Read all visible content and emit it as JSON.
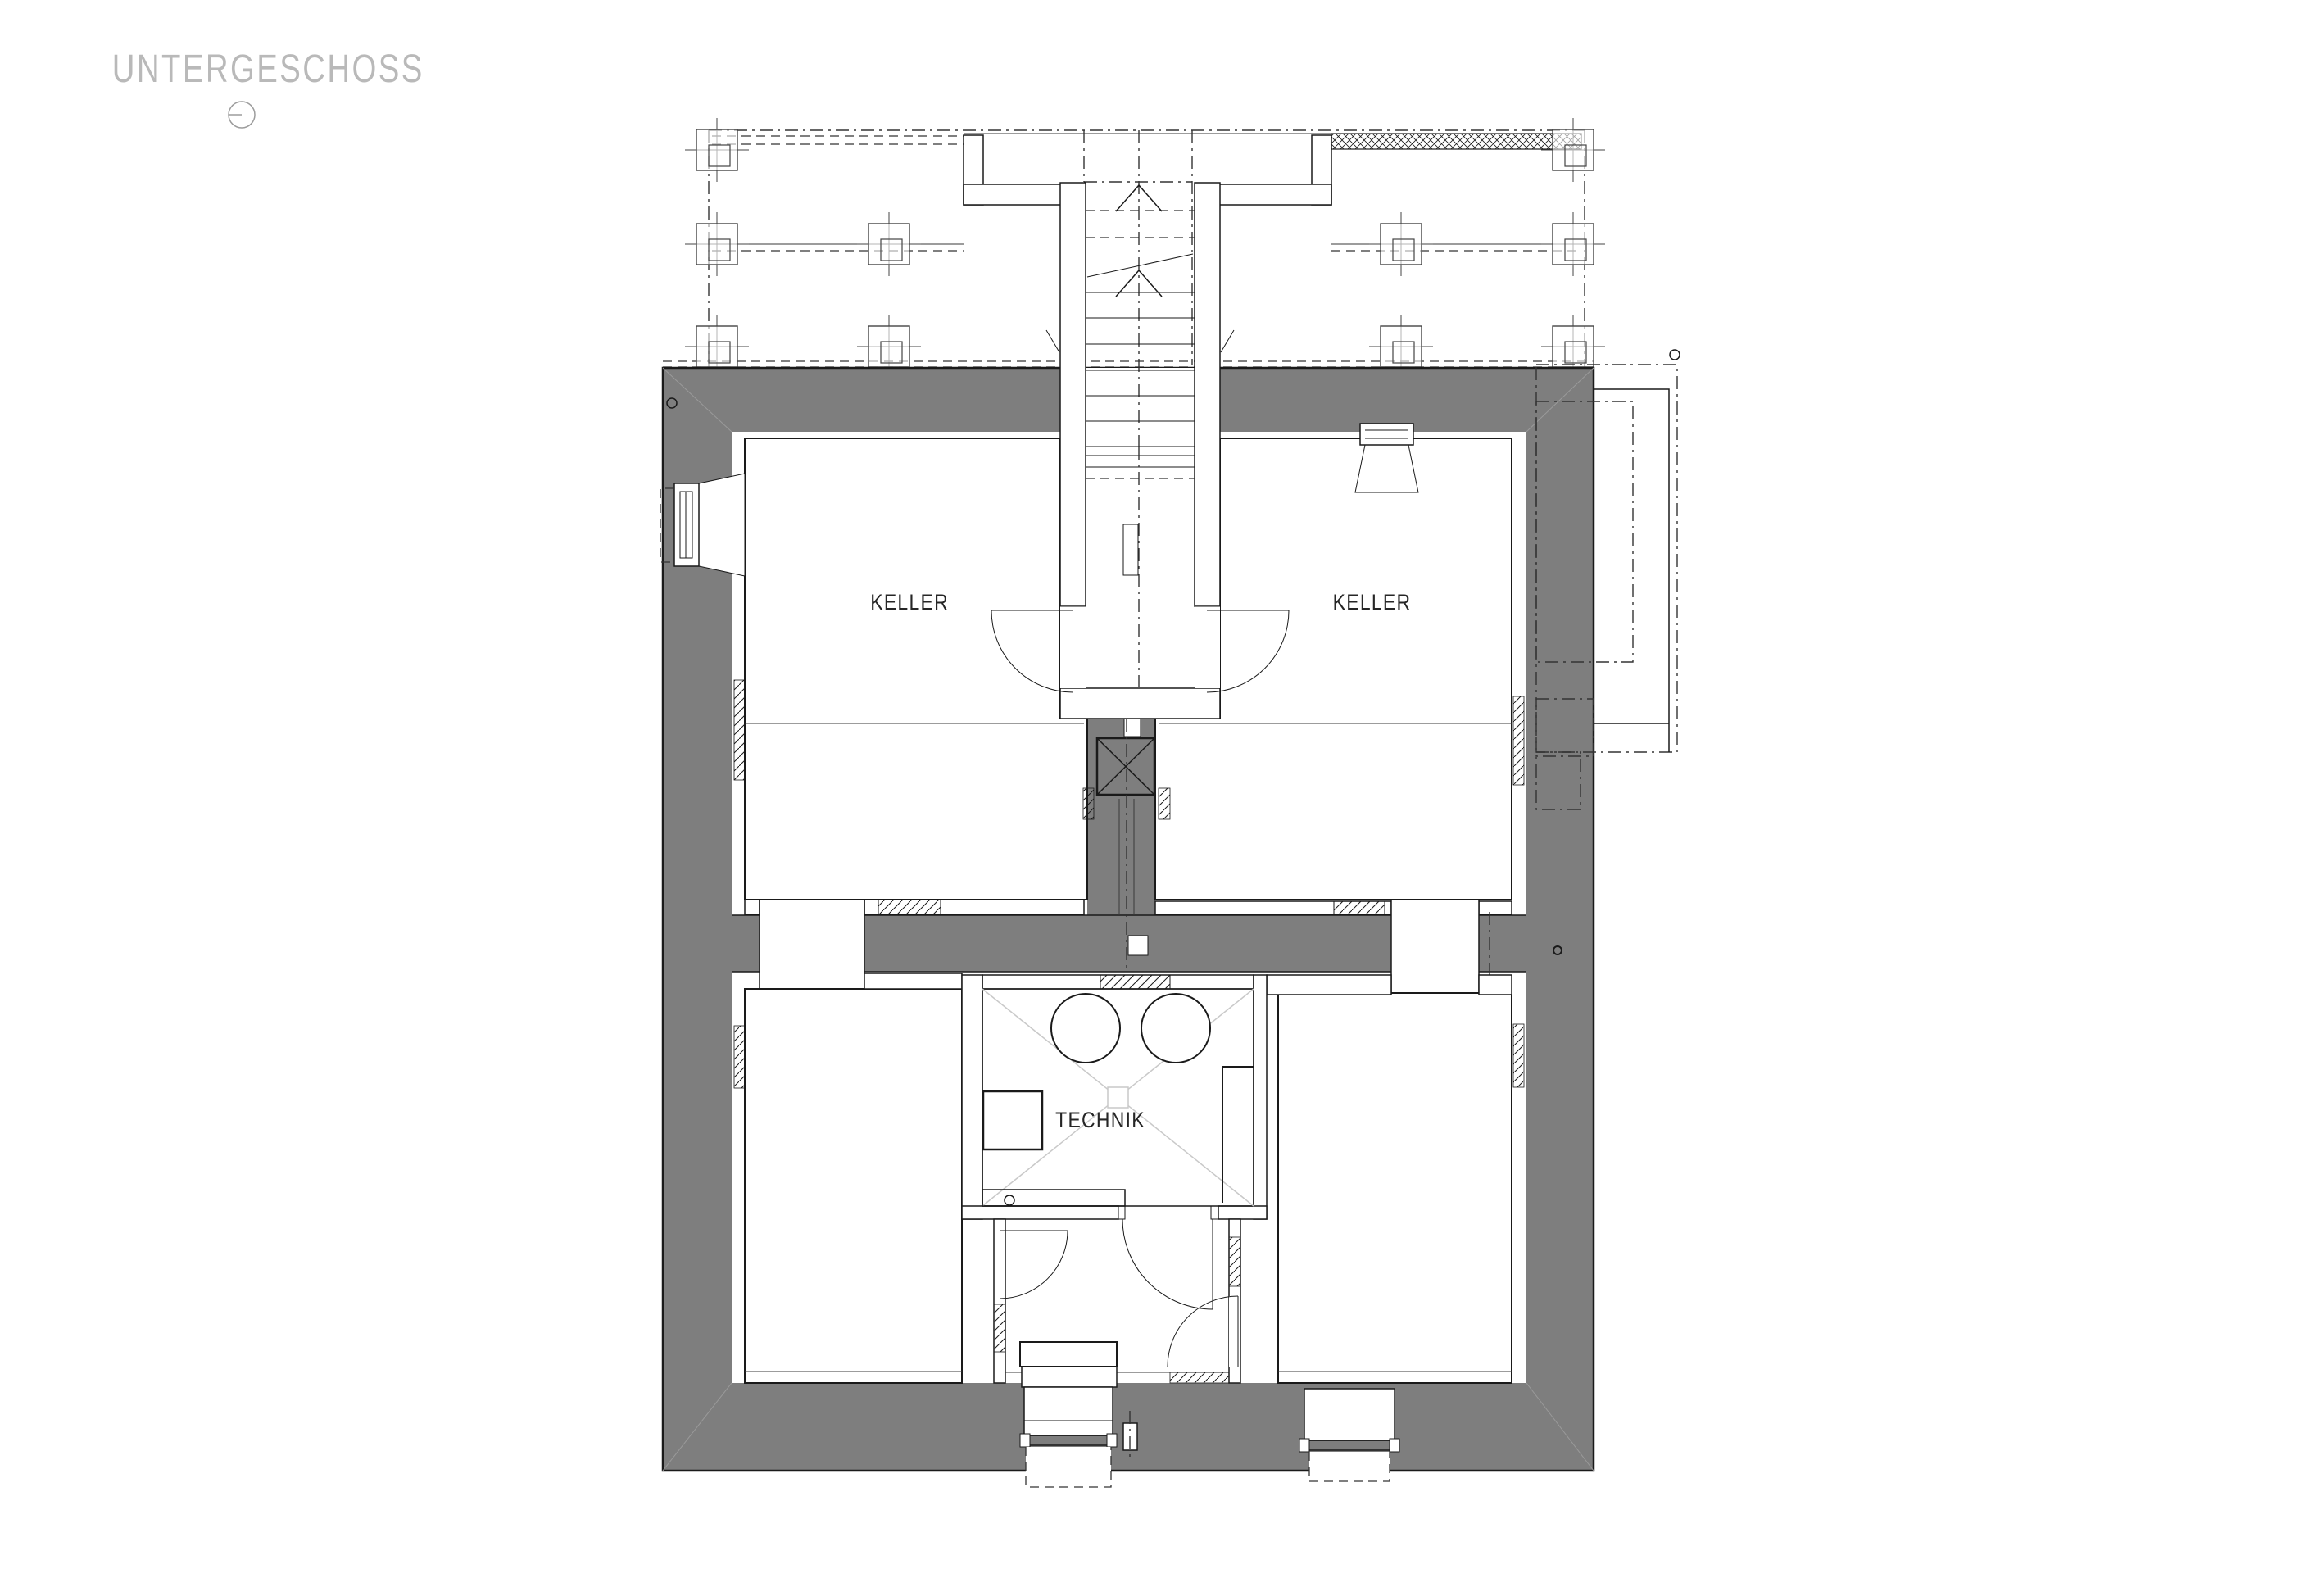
{
  "title": {
    "text": "UNTERGESCHOSS"
  },
  "symbols": {
    "orientation_circle": "circle-with-radius-line",
    "axis_circle_left": "small-circle-marker",
    "axis_circle_right": "small-circle-marker",
    "core_hole_right_wall": "small-circle-marker",
    "shaft_cross_box": "crossed-square-shaft-symbol",
    "floor_drain": "small-circle-drain"
  },
  "rooms": [
    {
      "id": "keller-left",
      "label": "KELLER"
    },
    {
      "id": "keller-right",
      "label": "KELLER"
    },
    {
      "id": "technik",
      "label": "TECHNIK"
    }
  ],
  "colors": {
    "background": "#ffffff",
    "wall_poche": "#7e7e7e",
    "line": "#1a1a1a",
    "light_marking": "#c9c9c9",
    "title_text": "#b9b9b9"
  },
  "drawing": {
    "type": "architectural-floor-plan",
    "floor": "basement",
    "elements": [
      "terrace-outline-above",
      "column-grid",
      "stairwell",
      "two-cellar-rooms",
      "technik-room-with-tanks",
      "vestibule",
      "light-wells",
      "exterior-light-shaft-right"
    ]
  }
}
